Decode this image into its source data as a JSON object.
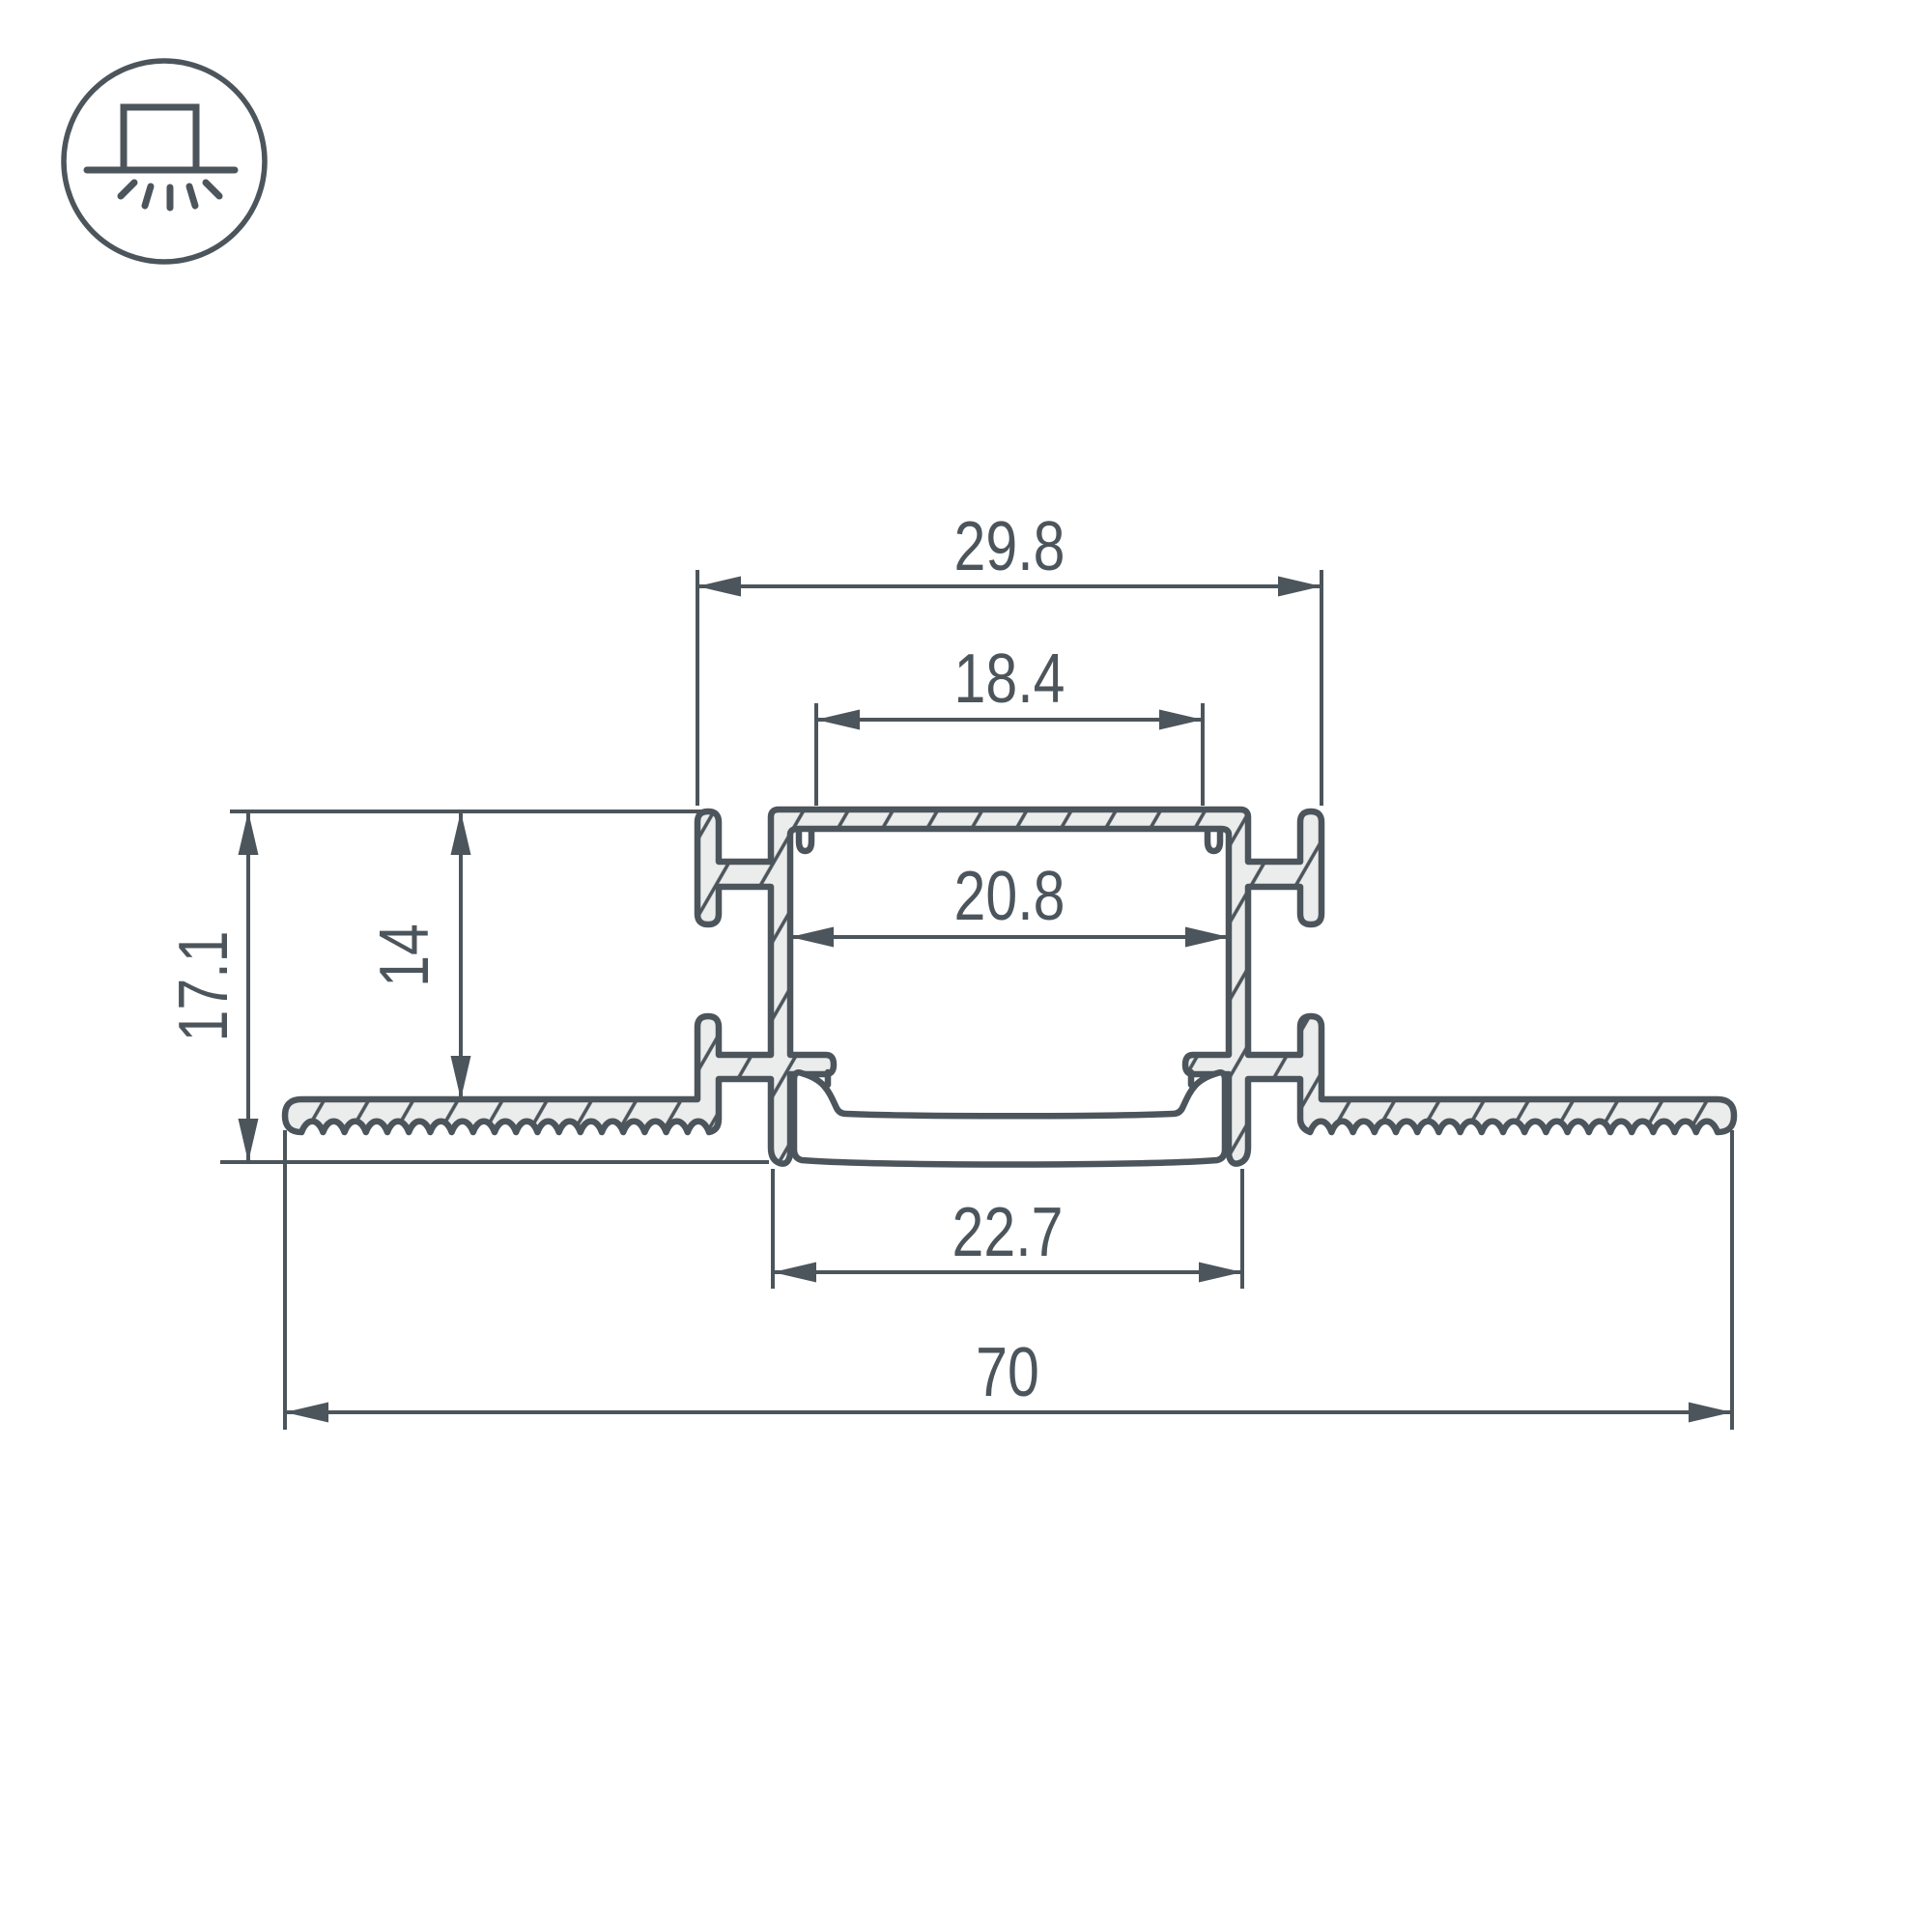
{
  "drawing": {
    "type": "led-profile-cross-section",
    "icon": {
      "name": "recessed-mount-icon"
    },
    "colors": {
      "line": "#4c555b",
      "aluminum_fill": "#ebecec",
      "background": "#ffffff"
    },
    "dimensions": {
      "outer_top_width": "29.8",
      "hook_inner_width": "18.4",
      "channel_inner_width": "20.8",
      "channel_depth": "14",
      "total_depth": "17.1",
      "bottom_opening_width": "22.7",
      "overall_width": "70"
    }
  }
}
